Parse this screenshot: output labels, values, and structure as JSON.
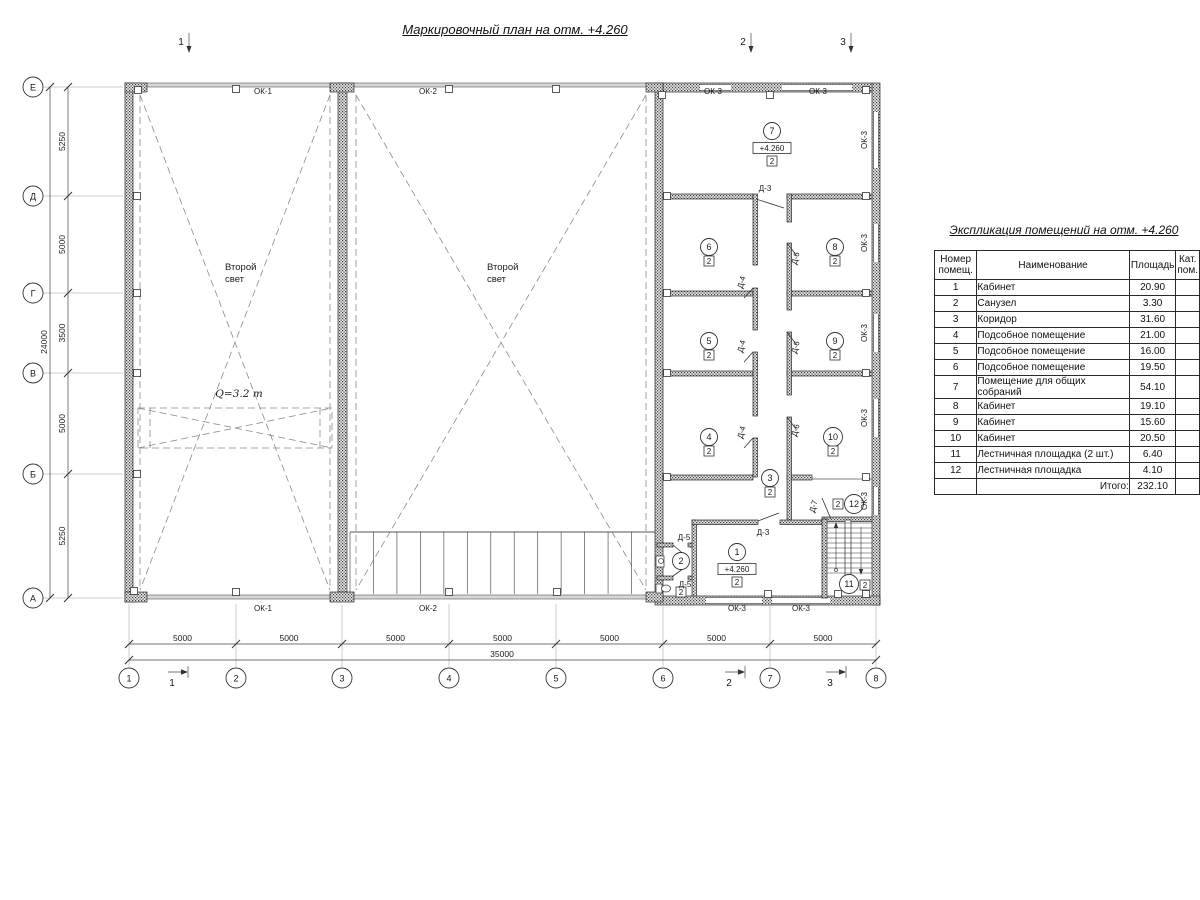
{
  "page": {
    "title": "Маркировочный план на отм. +4.260"
  },
  "table": {
    "title": "Экспликация помещений на отм. +4.260",
    "col_num": "Номер помещ.",
    "col_name": "Наименование",
    "col_area": "Площадь",
    "col_cat": "Кат. пом.",
    "rows": [
      [
        "1",
        "Кабинет",
        "20.90",
        ""
      ],
      [
        "2",
        "Санузел",
        "3.30",
        ""
      ],
      [
        "3",
        "Коридор",
        "31.60",
        ""
      ],
      [
        "4",
        "Подсобное помещение",
        "21.00",
        ""
      ],
      [
        "5",
        "Подсобное помещение",
        "16.00",
        ""
      ],
      [
        "6",
        "Подсобное помещение",
        "19.50",
        ""
      ],
      [
        "7",
        "Помещение для общих собраний",
        "54.10",
        ""
      ],
      [
        "8",
        "Кабинет",
        "19.10",
        ""
      ],
      [
        "9",
        "Кабинет",
        "15.60",
        ""
      ],
      [
        "10",
        "Кабинет",
        "20.50",
        ""
      ],
      [
        "11",
        "Лестничная площадка (2 шт.)",
        "6.40",
        ""
      ],
      [
        "12",
        "Лестничная площадка",
        "4.10",
        ""
      ]
    ],
    "total_label": "Итого:",
    "total_value": "232.10"
  },
  "axes": {
    "bottom": [
      "1",
      "2",
      "3",
      "4",
      "5",
      "6",
      "7",
      "8"
    ],
    "left": [
      "Е",
      "Д",
      "Г",
      "В",
      "Б",
      "А"
    ]
  },
  "dims": {
    "bottom": [
      "5000",
      "5000",
      "5000",
      "5000",
      "5000",
      "5000",
      "5000"
    ],
    "bottom_total": "35000",
    "left": [
      "5250",
      "5000",
      "3500",
      "5000",
      "5250"
    ],
    "left_total": "24000"
  },
  "sections": {
    "top": [
      {
        "t": "1",
        "x": 181
      },
      {
        "t": "2",
        "x": 743
      },
      {
        "t": "3",
        "x": 843
      }
    ],
    "bottom": [
      {
        "t": "1",
        "x": 188
      },
      {
        "t": "2",
        "x": 745
      },
      {
        "t": "3",
        "x": 846
      }
    ]
  },
  "rooms": [
    {
      "num": "7",
      "x": 772,
      "y": 131,
      "elev": "+4.260",
      "cat": "2"
    },
    {
      "num": "6",
      "x": 709,
      "y": 247,
      "cat": "2"
    },
    {
      "num": "8",
      "x": 835,
      "y": 247,
      "cat": "2"
    },
    {
      "num": "5",
      "x": 709,
      "y": 341,
      "cat": "2"
    },
    {
      "num": "9",
      "x": 835,
      "y": 341,
      "cat": "2"
    },
    {
      "num": "4",
      "x": 709,
      "y": 437,
      "cat": "2"
    },
    {
      "num": "10",
      "x": 833,
      "y": 437,
      "cat": "2"
    },
    {
      "num": "3",
      "x": 770,
      "y": 478,
      "cat": "2"
    },
    {
      "num": "1",
      "x": 737,
      "y": 552,
      "elev": "+4.260",
      "cat": "2"
    },
    {
      "num": "2",
      "x": 681,
      "y": 561,
      "cat": "2",
      "cat_x": 681,
      "cat_y": 592
    },
    {
      "num": "11",
      "x": 849,
      "y": 584,
      "cat": "2",
      "cat_x": 865,
      "cat_y": 585
    },
    {
      "num": "12",
      "x": 854,
      "y": 504,
      "cat": "2",
      "cat_x": 838,
      "cat_y": 504
    }
  ],
  "labels": {
    "windows": [
      {
        "t": "ОК-1",
        "x": 263,
        "y": 94
      },
      {
        "t": "ОК-2",
        "x": 428,
        "y": 94
      },
      {
        "t": "ОК-3",
        "x": 713,
        "y": 94
      },
      {
        "t": "ОК-3",
        "x": 818,
        "y": 94
      },
      {
        "t": "ОК-1",
        "x": 263,
        "y": 611
      },
      {
        "t": "ОК-2",
        "x": 428,
        "y": 611
      },
      {
        "t": "ОК-3",
        "x": 737,
        "y": 611
      },
      {
        "t": "ОК-3",
        "x": 801,
        "y": 611
      },
      {
        "t": "ОК-3",
        "x": 867,
        "y": 140,
        "rot": -90
      },
      {
        "t": "ОК-3",
        "x": 867,
        "y": 243,
        "rot": -90
      },
      {
        "t": "ОК-3",
        "x": 867,
        "y": 333,
        "rot": -90
      },
      {
        "t": "ОК-3",
        "x": 867,
        "y": 418,
        "rot": -90
      },
      {
        "t": "ОК-3",
        "x": 867,
        "y": 501,
        "rot": -90
      }
    ],
    "doors": [
      {
        "t": "Д-3",
        "x": 765,
        "y": 191
      },
      {
        "t": "Д-3",
        "x": 763,
        "y": 535
      },
      {
        "t": "Д-4",
        "x": 744,
        "y": 283,
        "rot": -75
      },
      {
        "t": "Д-4",
        "x": 744,
        "y": 347,
        "rot": -75
      },
      {
        "t": "Д-4",
        "x": 744,
        "y": 433,
        "rot": -75
      },
      {
        "t": "Д-6",
        "x": 798,
        "y": 259,
        "rot": -75
      },
      {
        "t": "Д-6",
        "x": 798,
        "y": 348,
        "rot": -75
      },
      {
        "t": "Д-6",
        "x": 798,
        "y": 431,
        "rot": -75
      },
      {
        "t": "Д-5",
        "x": 684,
        "y": 540
      },
      {
        "t": "Д-5",
        "x": 685,
        "y": 587
      },
      {
        "t": "Д-7",
        "x": 816,
        "y": 507,
        "rot": -75
      }
    ]
  },
  "plan_texts": {
    "second_light": [
      {
        "lines": [
          "Второй",
          "свет"
        ],
        "x": 225,
        "y": 270
      },
      {
        "lines": [
          "Второй",
          "свет"
        ],
        "x": 487,
        "y": 270
      }
    ],
    "crane_label": {
      "t": "Q=3.2 т",
      "x": 239,
      "y": 397
    },
    "elevation": "+4.260"
  }
}
